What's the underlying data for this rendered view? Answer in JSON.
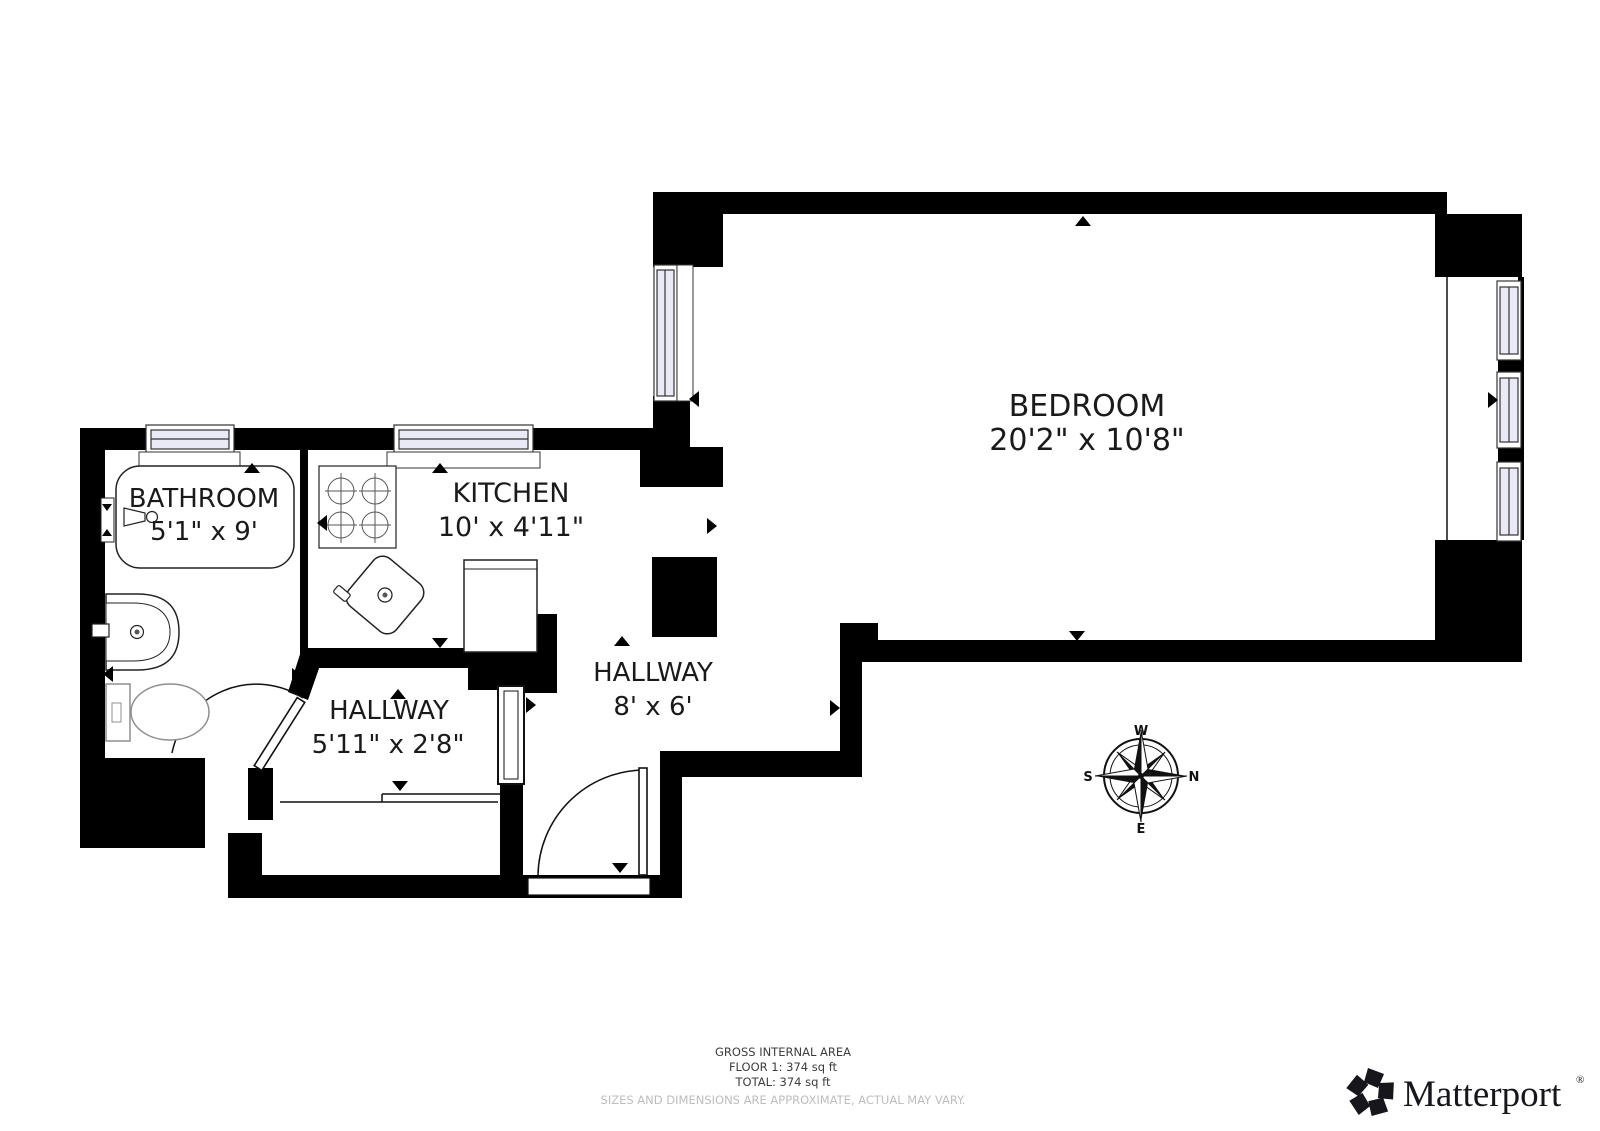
{
  "document_type": "floor-plan",
  "rooms": [
    {
      "name": "BATHROOM",
      "dimensions": "5'1\" x 9'"
    },
    {
      "name": "KITCHEN",
      "dimensions": "10' x 4'11\""
    },
    {
      "name": "BEDROOM",
      "dimensions": "20'2\" x 10'8\""
    },
    {
      "name": "HALLWAY",
      "dimensions": "5'11\" x 2'8\""
    },
    {
      "name": "HALLWAY",
      "dimensions": "8' x 6'"
    }
  ],
  "fixtures": [
    "bathtub",
    "bathroom-sink",
    "toilet",
    "stove-4-burners",
    "kitchen-sink",
    "kitchen-counter",
    "entry-door",
    "bathroom-door",
    "windows"
  ],
  "compass": {
    "north": "N",
    "east": "E",
    "south": "S",
    "west": "W",
    "orientation_note": "west-at-top"
  },
  "footer": {
    "line1": "GROSS INTERNAL AREA",
    "line2": "FLOOR 1: 374 sq ft",
    "line3": "TOTAL: 374 sq ft",
    "disclaimer": "SIZES AND DIMENSIONS ARE APPROXIMATE, ACTUAL MAY VARY."
  },
  "branding": {
    "logo_text": "Matterport",
    "registered_mark": "®"
  },
  "colors": {
    "walls": "#000000",
    "window_glass": "#e9eaf6",
    "fixture_line": "#222222",
    "toilet_line": "#8f8f8f",
    "footer_text": "#3d3d3d",
    "disclaimer_text": "#bdbdbd",
    "logo_color": "#17171b"
  }
}
